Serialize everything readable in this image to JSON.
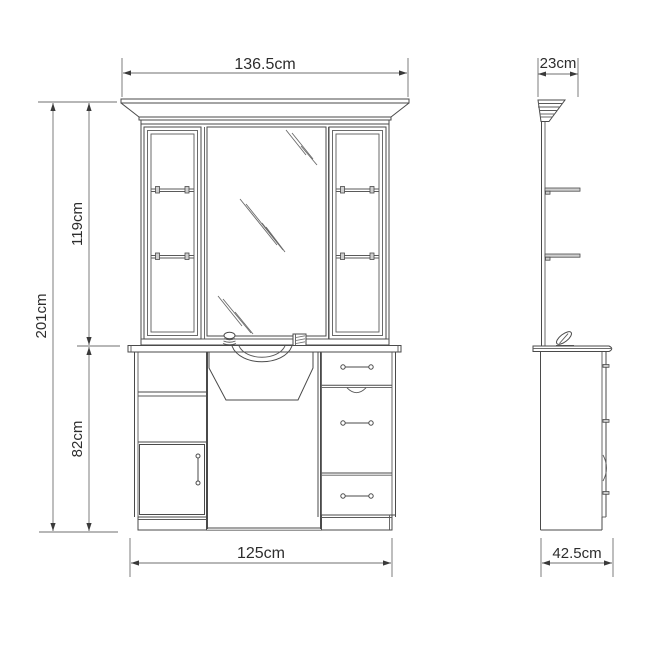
{
  "drawing": {
    "type": "furniture technical drawing",
    "subject": "mirrored dressing / salon station with display cabinets, sink counter, drawers and door",
    "views": [
      "front elevation",
      "side elevation"
    ]
  },
  "dimensions": {
    "front_width": "136.5cm",
    "crown_depth": "23cm",
    "total_height": "201cm",
    "upper_height": "119cm",
    "lower_height": "82cm",
    "base_width": "125cm",
    "base_depth": "42.5cm"
  },
  "icons": {
    "left_accessory": "dome-knob-icon",
    "right_accessory": "box-icon",
    "side_accessory": "faucet-icon"
  },
  "colors": {
    "background": "#ffffff",
    "line": "#4a4a4a",
    "dimension_line": "#6f6f6f",
    "text": "#2d2d2d"
  }
}
